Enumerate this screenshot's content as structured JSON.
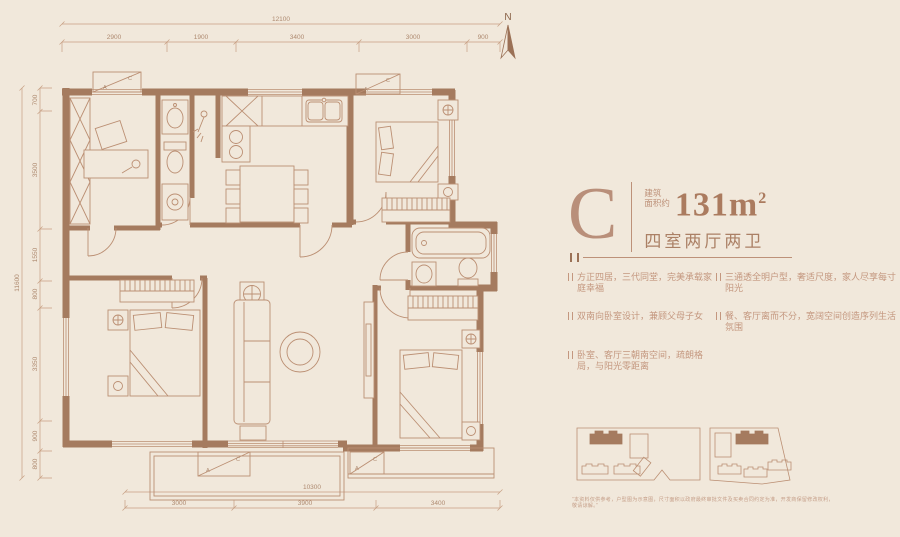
{
  "north": {
    "label": "N"
  },
  "plan": {
    "ac": {
      "a": "A",
      "c": "C"
    },
    "dims": {
      "top": {
        "total": "12100",
        "segments": [
          "2900",
          "1900",
          "3400",
          "3000",
          "900"
        ]
      },
      "left": {
        "total": "11600",
        "segments": [
          "700",
          "3500",
          "1550",
          "800",
          "3350",
          "900",
          "800"
        ]
      },
      "bottom": {
        "total": "10300",
        "segments": [
          "3000",
          "3900",
          "3400"
        ]
      }
    }
  },
  "info": {
    "type_letter": "C",
    "area_prefix_line1": "建筑",
    "area_prefix_line2": "面积约",
    "area_number": "131",
    "area_unit": "m",
    "area_power": "2",
    "layout": "四室两厅两卫",
    "features": [
      "方正四居，三代同堂，完美承载家庭幸福",
      "三通透全明户型，奢适尺度，家人尽享每寸阳光",
      "双南向卧室设计，兼顾父母子女",
      "餐、客厅离而不分，宽阔空间创造序列生活氛围",
      "卧室、客厅三朝南空间，疏朗格局，与阳光零距离"
    ],
    "disclaimer": "“本资料仅供参考，户型图为示意图，尺寸面积以政府最终审批文件及买卖合同约定为准，开发商保留修改权利，敬请谅解。”"
  }
}
